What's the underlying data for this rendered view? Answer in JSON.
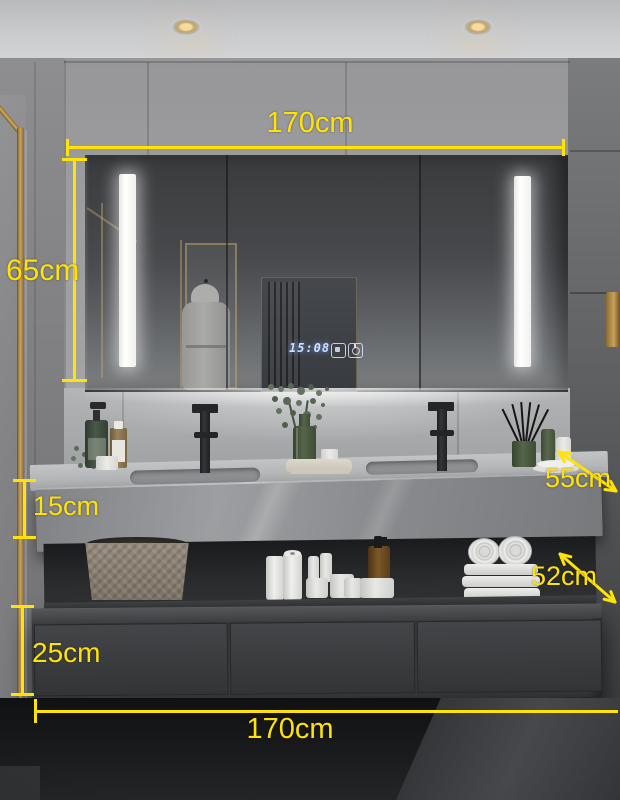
{
  "meta": {
    "type": "product-photo",
    "subject": "bathroom vanity with LED mirror cabinet"
  },
  "colors": {
    "annotation_yellow": "#FFE206",
    "clock_blue": "#CFE0FF",
    "brass_gold": "#C8A258",
    "cabinet_gray": "#3A3C3E",
    "wall_gray": "#9B9B9D"
  },
  "dimensions": {
    "top_width": "170cm",
    "mirror_height": "65cm",
    "counter_depth": "55cm",
    "counter_thickness": "15cm",
    "shelf_depth": "52cm",
    "drawer_height": "25cm",
    "bottom_width": "170cm"
  },
  "mirror": {
    "clock_time": "15:08",
    "touch_icons": [
      "defog-icon",
      "power-icon"
    ]
  },
  "scene_icons": [
    "ceiling-spotlight-icon",
    "shower-gold-frame-icon",
    "led-mirror-cabinet-icon",
    "led-strip-icon",
    "bathrobe-reflection-icon",
    "black-faucet-icon",
    "soap-pump-bottle-icon",
    "amber-bottle-icon",
    "eucalyptus-vase-icon",
    "folded-towel-icon",
    "reed-diffuser-icon",
    "woven-basket-icon",
    "toilet-paper-icon",
    "cosmetic-jar-icon",
    "towel-stack-icon",
    "drawer-cabinet-icon",
    "gold-towel-holder-icon"
  ]
}
